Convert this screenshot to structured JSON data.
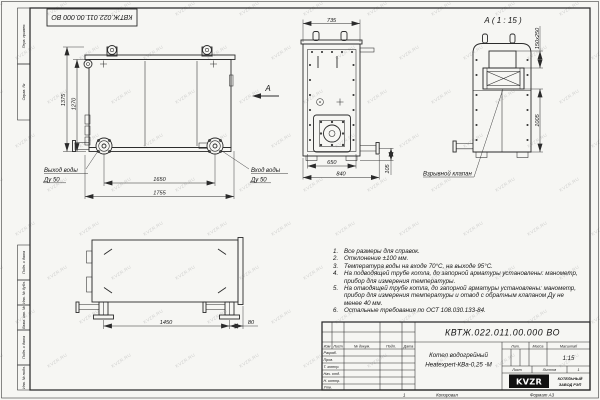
{
  "watermark": {
    "text": "KVZR.RU"
  },
  "frame": {
    "doc_number_rotated": "КВТЖ.022.011.00.000 ВО",
    "margin_labels": [
      "Перв. примен.",
      "Справ. №",
      "Подп. и дата",
      "Инв. № дубл.",
      "Взам. инв. №",
      "Подп. и дата",
      "Инв. № подл."
    ],
    "zone": "1",
    "copied": "Копировал",
    "format": "Формат А3"
  },
  "views": {
    "front": {
      "dim_height_total": "1375",
      "dim_height_body": "1270",
      "dim_width_flanges": "1650",
      "dim_width_total": "1755",
      "outlet_label": "Выход воды",
      "outlet_dn": "Ду 50",
      "inlet_label": "Вход воды",
      "inlet_dn": "Ду 50",
      "view_mark": "А"
    },
    "side": {
      "dim_top": "735",
      "dim_width_body": "650",
      "dim_width_total": "840",
      "dim_pipe_height": "105"
    },
    "detail": {
      "title": "А ( 1 : 15 )",
      "dim_valve": "150х250",
      "dim_height": "1005",
      "valve_label": "Взрывной клапан"
    },
    "bottom": {
      "dim_leg_span": "1450",
      "dim_offset": "80"
    }
  },
  "notes": {
    "items": [
      {
        "num": "1.",
        "text": "Все размеры для справок."
      },
      {
        "num": "2.",
        "text": "Отклонение ±100 мм."
      },
      {
        "num": "3.",
        "text": "Температура воды на входе 70°С, на выходе 95°С."
      },
      {
        "num": "4.",
        "text": "На подводящей трубе котла, до запорной арматуры установлены: манометр, прибор для измерения температуры."
      },
      {
        "num": "5.",
        "text": "На отводящей трубе котла, до запорной арматуры установлены: манометр, прибор для измерения температуры и отвод с обратным клапаном Ду не менее 40 мм."
      },
      {
        "num": "6.",
        "text": "Остальные требования по ОСТ 108.030.133-84."
      }
    ]
  },
  "title_block": {
    "doc_number": "КВТЖ.022.011.00.000 ВО",
    "name_line1": "Котел водогрейный",
    "name_line2": "Heatexpert-КВа-0,25 -М",
    "cols": [
      "Изм",
      "Лист",
      "№ докум.",
      "Подп.",
      "Дата"
    ],
    "rows": [
      "Разраб.",
      "Пров.",
      "Т. контр.",
      "Нач. отд.",
      "Н. контр.",
      "Утв."
    ],
    "headers": {
      "lit": "Лит.",
      "mass": "Масса",
      "scale": "Масштаб"
    },
    "scale_value": "1:15",
    "sheet_label": "Лист",
    "sheets_label": "Листов",
    "sheets_value": "1",
    "logo_text": "KVZR",
    "org_line1": "КОТЕЛЬНЫЙ",
    "org_line2": "ЗАВОД РЭП"
  }
}
